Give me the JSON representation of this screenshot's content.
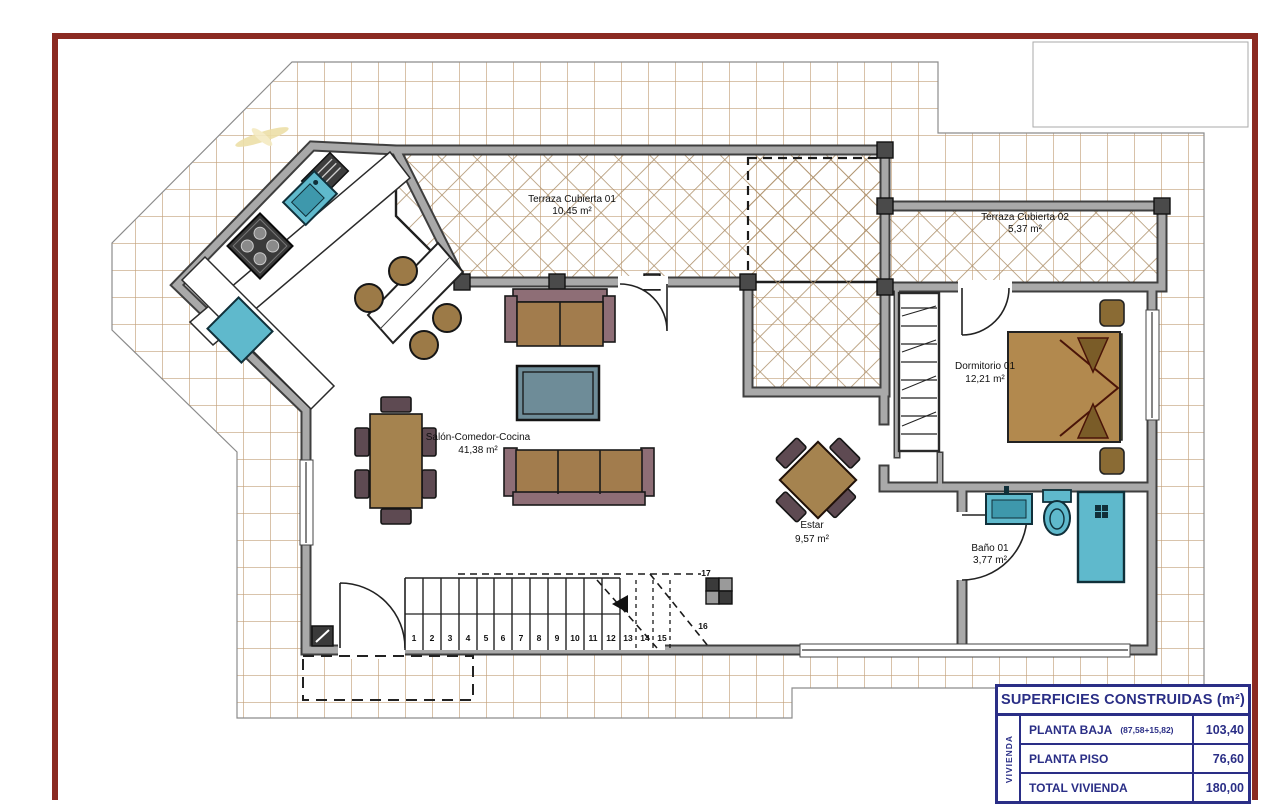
{
  "palette": {
    "sheet_border": "#8B2A22",
    "site_grid_line": "#C2A07A",
    "terrace_hatch_line": "#AE916C",
    "wall_dark": "#3F3F3F",
    "wall_light": "#A9A9A9",
    "fixture_teal": "#5FB9CC",
    "sofa_brown": "#A27C4D",
    "sofa_frame_mauve": "#8E6E76",
    "coffee_table_slate": "#6E8C98",
    "wood_brown": "#A5834F",
    "chair_plum": "#5E4A52",
    "bed_brown": "#B2894E",
    "table_navy": "#2A2E86"
  },
  "rooms": {
    "terraza1": {
      "name": "Terraza Cubierta 01",
      "area": "10,45 m²"
    },
    "terraza2": {
      "name": "Terraza Cubierta 02",
      "area": "5,37 m²"
    },
    "salon": {
      "name": "Salón-Comedor-Cocina",
      "area": "41,38 m²"
    },
    "dormitorio": {
      "name": "Dormitorio 01",
      "area": "12,21 m²"
    },
    "estar": {
      "name": "Estar",
      "area": "9,57 m²"
    },
    "bano": {
      "name": "Baño 01",
      "area": "3,77 m²"
    }
  },
  "stairs": {
    "numbers": [
      "1",
      "2",
      "3",
      "4",
      "5",
      "6",
      "7",
      "8",
      "9",
      "10",
      "11",
      "12",
      "13",
      "14",
      "15"
    ],
    "label_top": "17",
    "label_mid": "16"
  },
  "summary_table": {
    "title": "SUPERFICIES CONSTRUIDAS (m²)",
    "group_label": "VIVIENDA",
    "rows": [
      {
        "label": "PLANTA BAJA",
        "note": "(87,58+15,82)",
        "value": "103,40"
      },
      {
        "label": "PLANTA PISO",
        "note": "",
        "value": "76,60"
      },
      {
        "label": "TOTAL VIVIENDA",
        "note": "",
        "value": "180,00"
      }
    ]
  }
}
